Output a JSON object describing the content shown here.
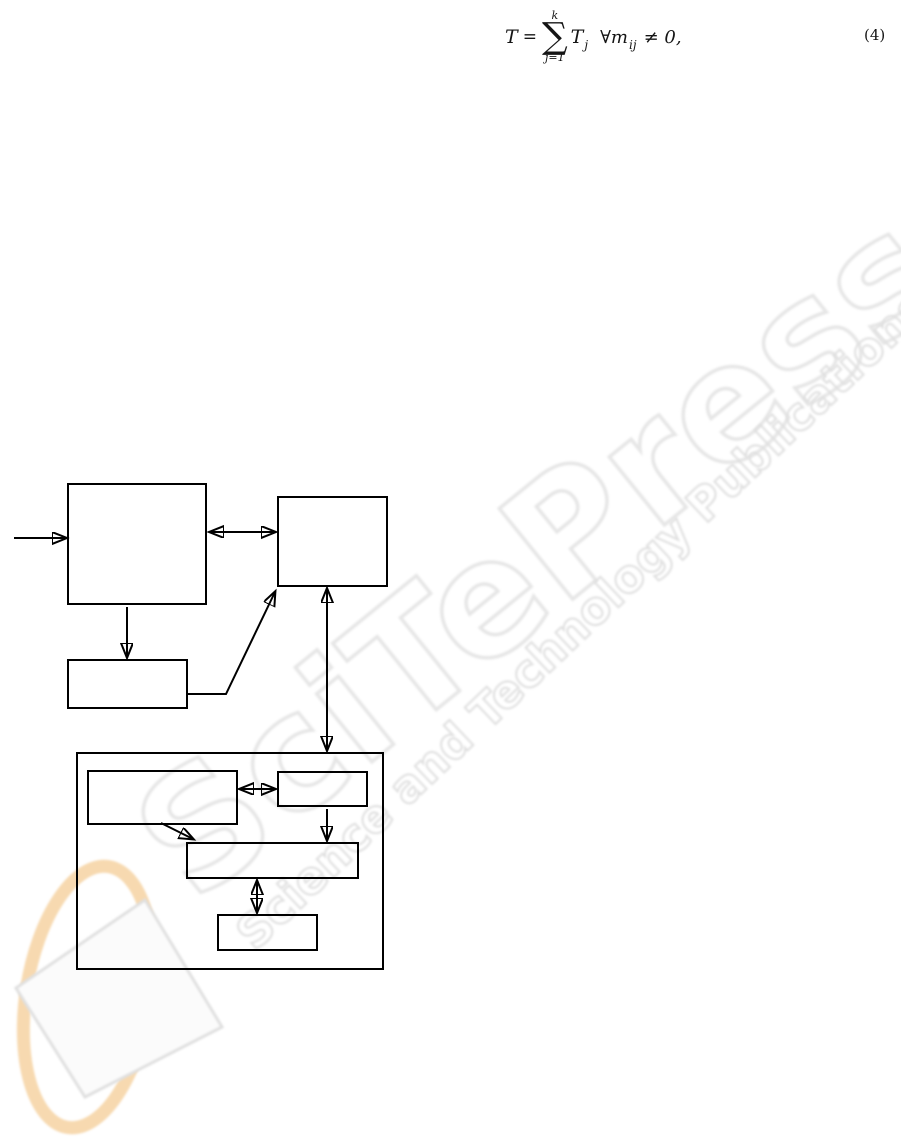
{
  "equation": {
    "lhs": "T",
    "equals": "=",
    "sum_upper": "k",
    "sum_symbol": "∑",
    "sum_lower": "j=1",
    "term": "T",
    "term_sub": "j",
    "condition": "∀m",
    "condition_sub": "ij",
    "rhs": "≠ 0,",
    "label": "(4)"
  },
  "watermark": {
    "title": "SciTePress",
    "subtitle": "Science and Technology Publications",
    "text_outline_color": "#e6e6e6",
    "logo_ring_color": "#f4cc96",
    "logo_diamond_fill": "#fbfbfb",
    "logo_diamond_stroke": "#e0e0e0"
  },
  "diagram": {
    "line_color": "#000000",
    "box_fill": "transparent",
    "box_count": 8,
    "labels": []
  }
}
